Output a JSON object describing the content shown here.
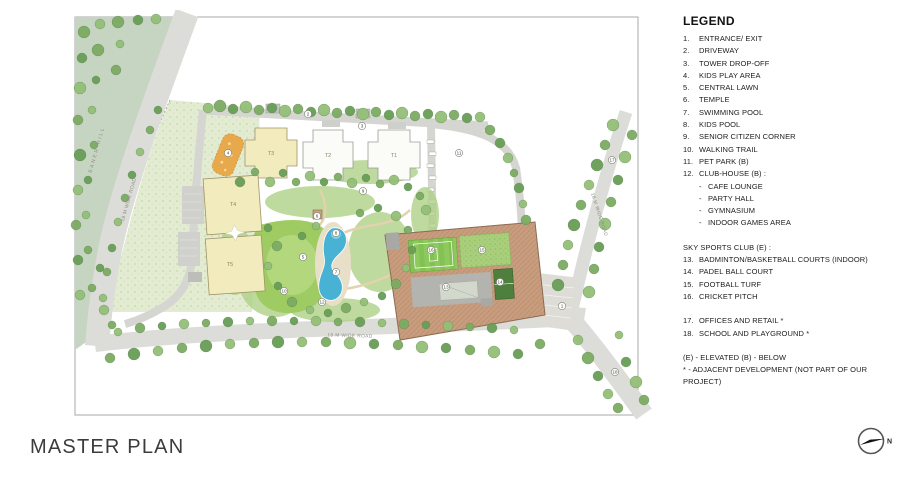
{
  "title": {
    "text": "MASTER PLAN"
  },
  "legend": {
    "title": "LEGEND",
    "rows": [
      {
        "cls": "item",
        "n": "1.",
        "t": "ENTRANCE/ EXIT"
      },
      {
        "cls": "item",
        "n": "2.",
        "t": "DRIVEWAY"
      },
      {
        "cls": "item",
        "n": "3.",
        "t": "TOWER DROP-OFF"
      },
      {
        "cls": "item",
        "n": "4.",
        "t": "KIDS PLAY AREA"
      },
      {
        "cls": "item",
        "n": "5.",
        "t": "CENTRAL LAWN"
      },
      {
        "cls": "item",
        "n": "6.",
        "t": "TEMPLE"
      },
      {
        "cls": "item",
        "n": "7.",
        "t": "SWIMMING POOL"
      },
      {
        "cls": "item",
        "n": "8.",
        "t": "KIDS POOL"
      },
      {
        "cls": "item",
        "n": "9.",
        "t": "SENIOR CITIZEN CORNER"
      },
      {
        "cls": "item",
        "n": "10.",
        "t": "WALKING TRAIL"
      },
      {
        "cls": "item",
        "n": "11.",
        "t": "PET PARK (B)"
      },
      {
        "cls": "item",
        "n": "12.",
        "t": "CLUB-HOUSE (B) :"
      },
      {
        "cls": "sub",
        "n": "-",
        "t": "CAFE LOUNGE"
      },
      {
        "cls": "sub",
        "n": "-",
        "t": "PARTY HALL"
      },
      {
        "cls": "sub",
        "n": "-",
        "t": "GYMNASIUM"
      },
      {
        "cls": "sub",
        "n": "-",
        "t": "INDOOR GAMES AREA"
      },
      {
        "cls": "gap"
      },
      {
        "cls": "head",
        "t": "SKY SPORTS CLUB (E) :"
      },
      {
        "cls": "item",
        "n": "13.",
        "t": "BADMINTON/BASKETBALL COURTS (INDOOR)"
      },
      {
        "cls": "item",
        "n": "14.",
        "t": "PADEL BALL COURT"
      },
      {
        "cls": "item",
        "n": "15.",
        "t": "FOOTBALL TURF"
      },
      {
        "cls": "item",
        "n": "16.",
        "t": "CRICKET PITCH"
      },
      {
        "cls": "gap"
      },
      {
        "cls": "item",
        "n": "17.",
        "t": "OFFICES AND RETAIL *"
      },
      {
        "cls": "item",
        "n": "18.",
        "t": "SCHOOL AND PLAYGROUND *"
      },
      {
        "cls": "gap"
      },
      {
        "cls": "foot",
        "t": "(E) - ELEVATED (B) - BELOW"
      },
      {
        "cls": "foot",
        "t": "* - ADJACENT DEVELOPMENT (NOT PART OF OUR PROJECT)"
      }
    ]
  },
  "plan": {
    "markers": [
      {
        "n": "1",
        "x": 492,
        "y": 296
      },
      {
        "n": "2",
        "x": 238,
        "y": 104
      },
      {
        "n": "3",
        "x": 292,
        "y": 116
      },
      {
        "n": "4",
        "x": 158,
        "y": 143
      },
      {
        "n": "5",
        "x": 233,
        "y": 247
      },
      {
        "n": "6",
        "x": 247,
        "y": 206
      },
      {
        "n": "7",
        "x": 266,
        "y": 262
      },
      {
        "n": "8",
        "x": 266,
        "y": 223
      },
      {
        "n": "9",
        "x": 293,
        "y": 181
      },
      {
        "n": "10",
        "x": 214,
        "y": 281
      },
      {
        "n": "11",
        "x": 389,
        "y": 143
      },
      {
        "n": "12",
        "x": 252,
        "y": 292
      },
      {
        "n": "13",
        "x": 376,
        "y": 277
      },
      {
        "n": "14",
        "x": 430,
        "y": 272
      },
      {
        "n": "15",
        "x": 412,
        "y": 240
      },
      {
        "n": "16",
        "x": 361,
        "y": 240
      },
      {
        "n": "17",
        "x": 542,
        "y": 150
      },
      {
        "n": "18",
        "x": 545,
        "y": 362
      }
    ],
    "towers": [
      {
        "label": "T3",
        "x": 201,
        "y": 145
      },
      {
        "label": "T2",
        "x": 258,
        "y": 147
      },
      {
        "label": "T1",
        "x": 324,
        "y": 147
      },
      {
        "label": "T4",
        "x": 163,
        "y": 196
      },
      {
        "label": "T5",
        "x": 160,
        "y": 256
      }
    ],
    "road_labels": [
      {
        "t": "BANER HILL",
        "x": 28,
        "y": 140,
        "r": -74,
        "ls": 2
      },
      {
        "t": "18 M WIDE ROAD",
        "x": 60,
        "y": 190,
        "r": -74,
        "ls": 0.4
      },
      {
        "t": "18 M WIDE ROAD",
        "x": 280,
        "y": 327,
        "r": 2,
        "ls": 0.4
      },
      {
        "t": "18 M WIDE ROAD",
        "x": 528,
        "y": 205,
        "r": 72,
        "ls": 0.4
      }
    ]
  },
  "north": {
    "label": "N"
  },
  "colors": {
    "tower_yellow": "#f2ebbd",
    "tower_white": "#fbfbf8",
    "pool_blue": "#47b2d3",
    "kids_pool_blue": "#87d1e2",
    "sports_club_brown": "#c89d7e",
    "lawn_green": "#9ecb62",
    "play_area_orange": "#e8a94d",
    "road_gray": "#dcdcd8",
    "hill_green": "#c6d4c2",
    "padel_green": "#4f7f3c"
  }
}
